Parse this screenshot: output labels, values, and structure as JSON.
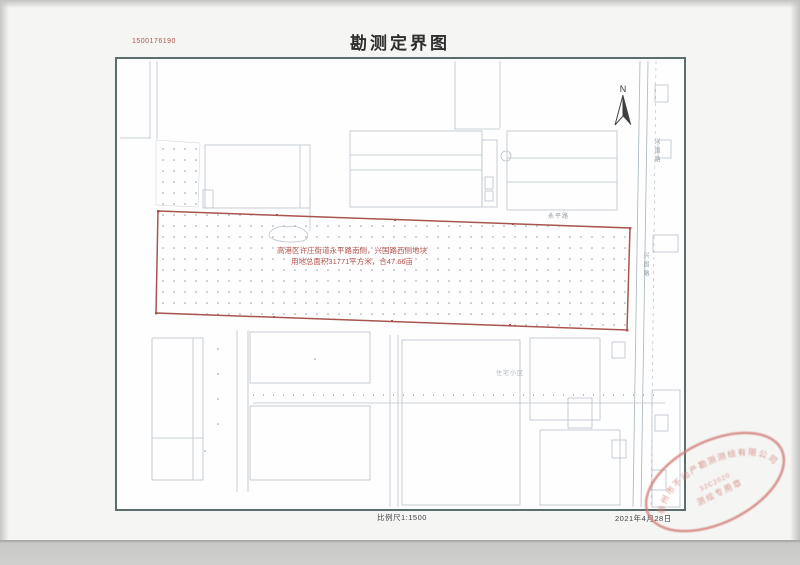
{
  "page": {
    "doc_number": "1500176190",
    "title": "勘测定界图",
    "scale_label": "比例尺1:1500",
    "date_label": "2021年4月28日"
  },
  "map": {
    "north_label": "N",
    "parcel_line1": "高港区许庄街道永平路南侧，兴国路西侧地块",
    "parcel_line2": "用地总面积31771平方米，合47.66亩",
    "road_label_east": "兴国路",
    "road_label_north": "永平路",
    "area_label_south": "住宅小区"
  },
  "seal": {
    "rim_text": "泰州市不动产勘测测绘有限公司",
    "center_line1": "32C2020",
    "center_line2": "测绘专用章"
  },
  "colors": {
    "boundary_red": "#a9544e",
    "annotation_red": "#b4524b",
    "map_line": "#b7c3cb",
    "frame_border": "#5b6e6e",
    "seal_red": "#cf7d76"
  }
}
